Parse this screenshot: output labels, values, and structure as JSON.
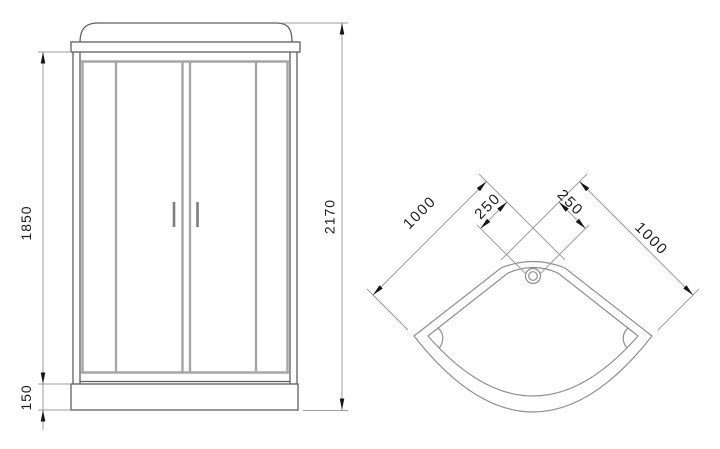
{
  "drawing": {
    "type": "technical dimension drawing",
    "subject": "corner shower cabin with sliding doors and quarter-round tray",
    "front_view": {
      "name": "front elevation",
      "dimensions": {
        "door_glass_height": "1850",
        "tray_height": "150",
        "total_height": "2170"
      }
    },
    "top_view": {
      "name": "tray plan view",
      "dimensions": {
        "left_side": "1000",
        "left_offset": "250",
        "right_offset": "250",
        "right_side": "1000"
      }
    }
  },
  "colors": {
    "background": "#ffffff",
    "outline": "#5f5f5f",
    "panel_gray": "#a6a6a6",
    "handle_gray": "#7d7d7d",
    "tray_line": "#8f8f8f",
    "dimension_line": "#9c9c9c",
    "arrow": "#151515",
    "text": "#1c1c1c"
  }
}
